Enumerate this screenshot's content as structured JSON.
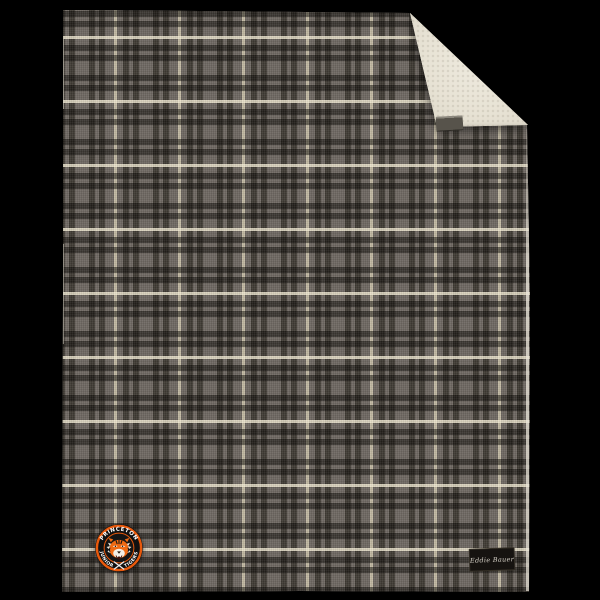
{
  "scene": {
    "type": "product-photo",
    "background_color": "#000000",
    "subject": "Gray plaid flannel blanket with folded corner revealing cream sherpa lining"
  },
  "blanket": {
    "plaid": {
      "base_gray": "#6e6861",
      "dark_stripe": "#3a362f",
      "cream_stripe": "#c9c1a9",
      "repeat_px": 64
    },
    "sherpa_lining_color": "#e9e4d6"
  },
  "logo_patch": {
    "shape": "circular-embroidered-patch",
    "top_text": "PRINCETON",
    "left_text": "JUNIOR",
    "right_text": "TIGERS",
    "center_emblem": "tiger-head",
    "bottom_emblem": "crossed-hockey-sticks",
    "ring_color": "#e8590c",
    "band_color": "#111111",
    "text_color": "#ffffff"
  },
  "brand_label": {
    "text": "Eddie Bauer",
    "background_color": "#161310",
    "text_color": "#d8d3c9"
  },
  "fold_tag": {
    "type": "blank-woven-tag",
    "color": "#57534b"
  }
}
